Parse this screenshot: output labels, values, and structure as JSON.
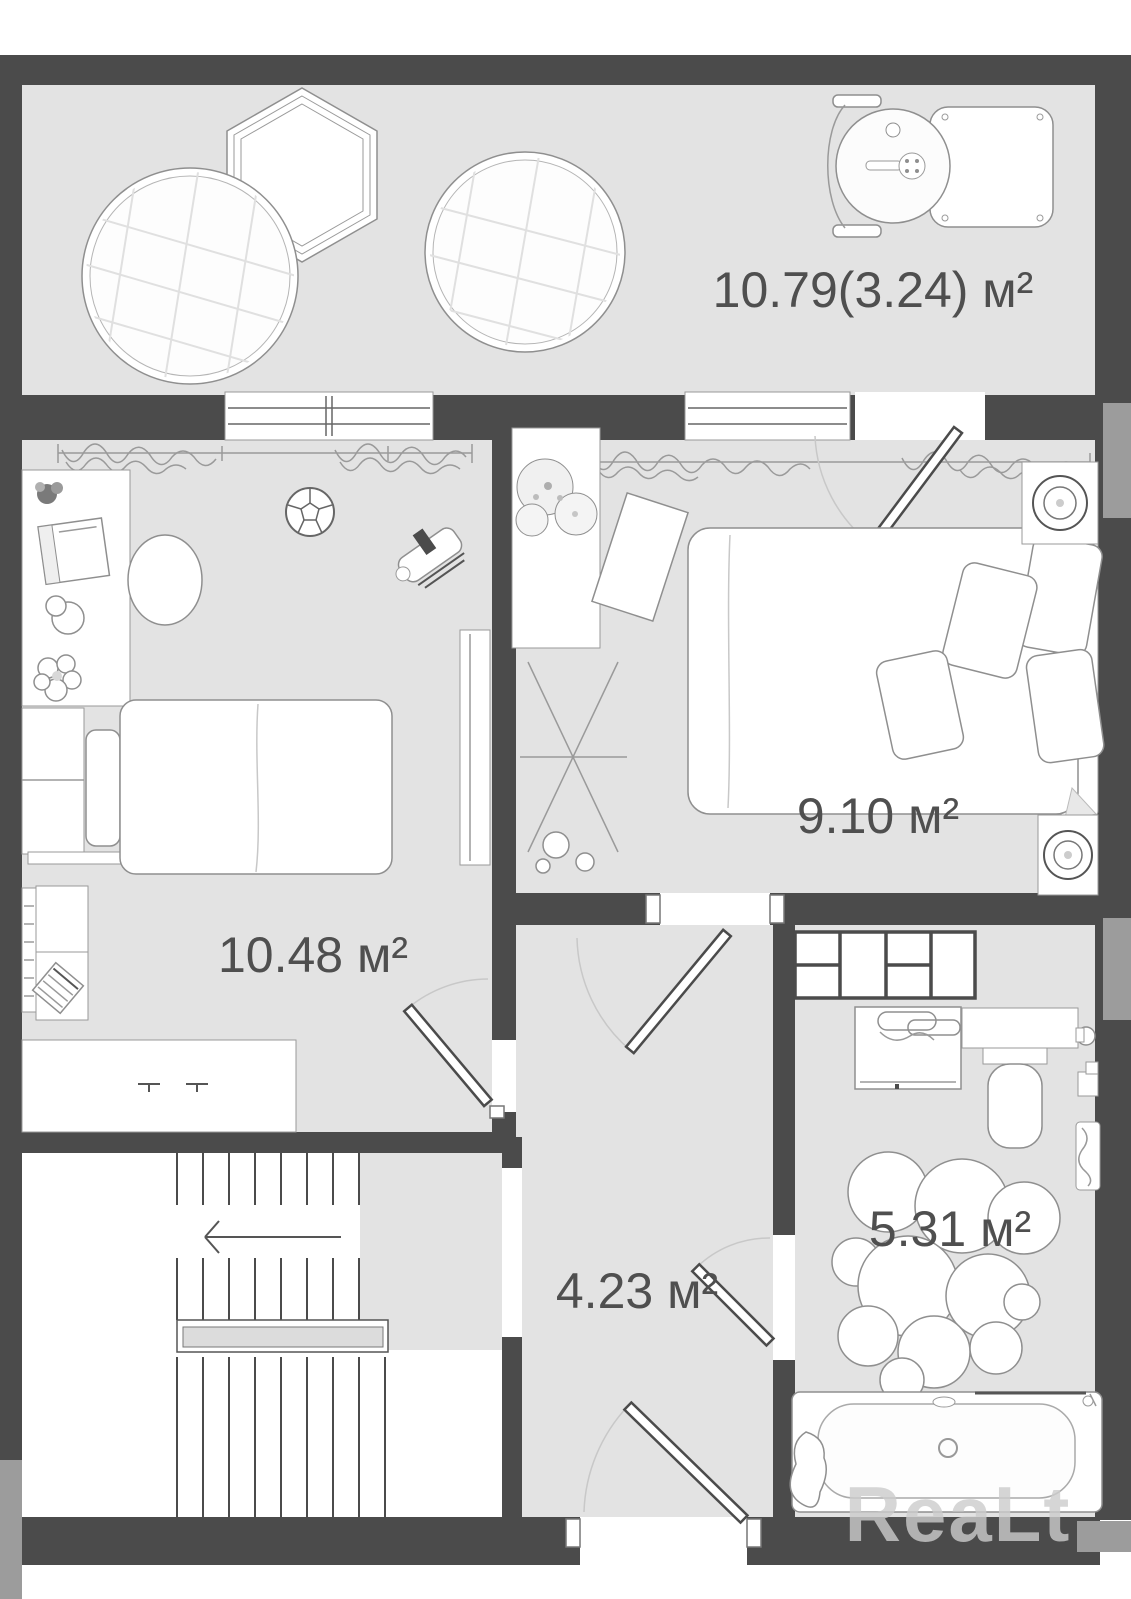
{
  "rooms": {
    "balcony": {
      "area_label": "10.79(3.24) м²"
    },
    "bedroom_left": {
      "area_label": "10.48 м²"
    },
    "bedroom_right": {
      "area_label": "9.10 м²"
    },
    "hallway": {
      "area_label": "4.23 м²"
    },
    "bathroom": {
      "area_label": "5.31 м²"
    }
  },
  "watermark": {
    "text": "ReaLt"
  },
  "colors": {
    "wall": "#4b4b4b",
    "floor": "#e3e3e3",
    "stair_floor": "#ffffff",
    "neighbor_gray": "#9c9c9c",
    "label_text": "#4f4f4f",
    "furniture_outline": "#8f8f8f",
    "furniture_fill": "#ffffff"
  }
}
